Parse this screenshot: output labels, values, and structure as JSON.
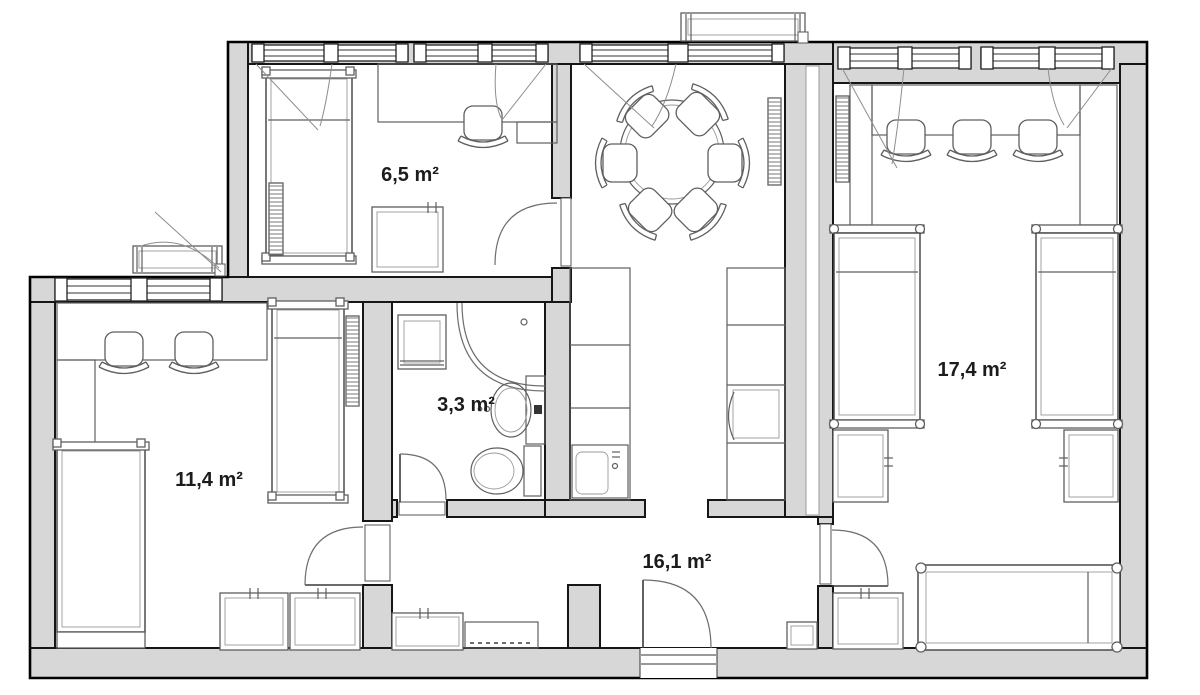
{
  "plan": {
    "type": "apartment-floor-plan",
    "colors": {
      "background": "#ffffff",
      "wall_fill": "#d7d7d7",
      "wall_outline": "#161616",
      "furniture_line": "#5f5f5f",
      "door_arc": "#6e6e6e",
      "label_text": "#1c1c1c"
    },
    "rooms": [
      {
        "id": "bedroom-top",
        "area_label": "6,5 m²",
        "furniture": [
          "single-bed",
          "desk",
          "office-chair",
          "wardrobe",
          "radiator",
          "door",
          "two-windows"
        ]
      },
      {
        "id": "bathroom",
        "area_label": "3,3 m²",
        "furniture": [
          "washing-machine",
          "corner-shower",
          "washbasin",
          "toilet",
          "door"
        ]
      },
      {
        "id": "bedroom-left",
        "area_label": "11,4 m²",
        "furniture": [
          "two-single-beds",
          "desk",
          "two-office-chairs",
          "two-wardrobes",
          "radiator",
          "window",
          "door"
        ]
      },
      {
        "id": "hall-kitchen-dining",
        "area_label": "16,1 m²",
        "furniture": [
          "round-dining-table",
          "six-chairs",
          "kitchen-counter-left",
          "kitchen-counter-right",
          "kitchen-sink",
          "oven",
          "radiator",
          "entrance-door",
          "hall-cabinets",
          "window"
        ]
      },
      {
        "id": "bedroom-right",
        "area_label": "17,4 m²",
        "furniture": [
          "two-single-beds",
          "day-bed",
          "desk",
          "three-office-chairs",
          "three-wardrobes",
          "radiator",
          "door",
          "two-windows"
        ]
      }
    ]
  }
}
